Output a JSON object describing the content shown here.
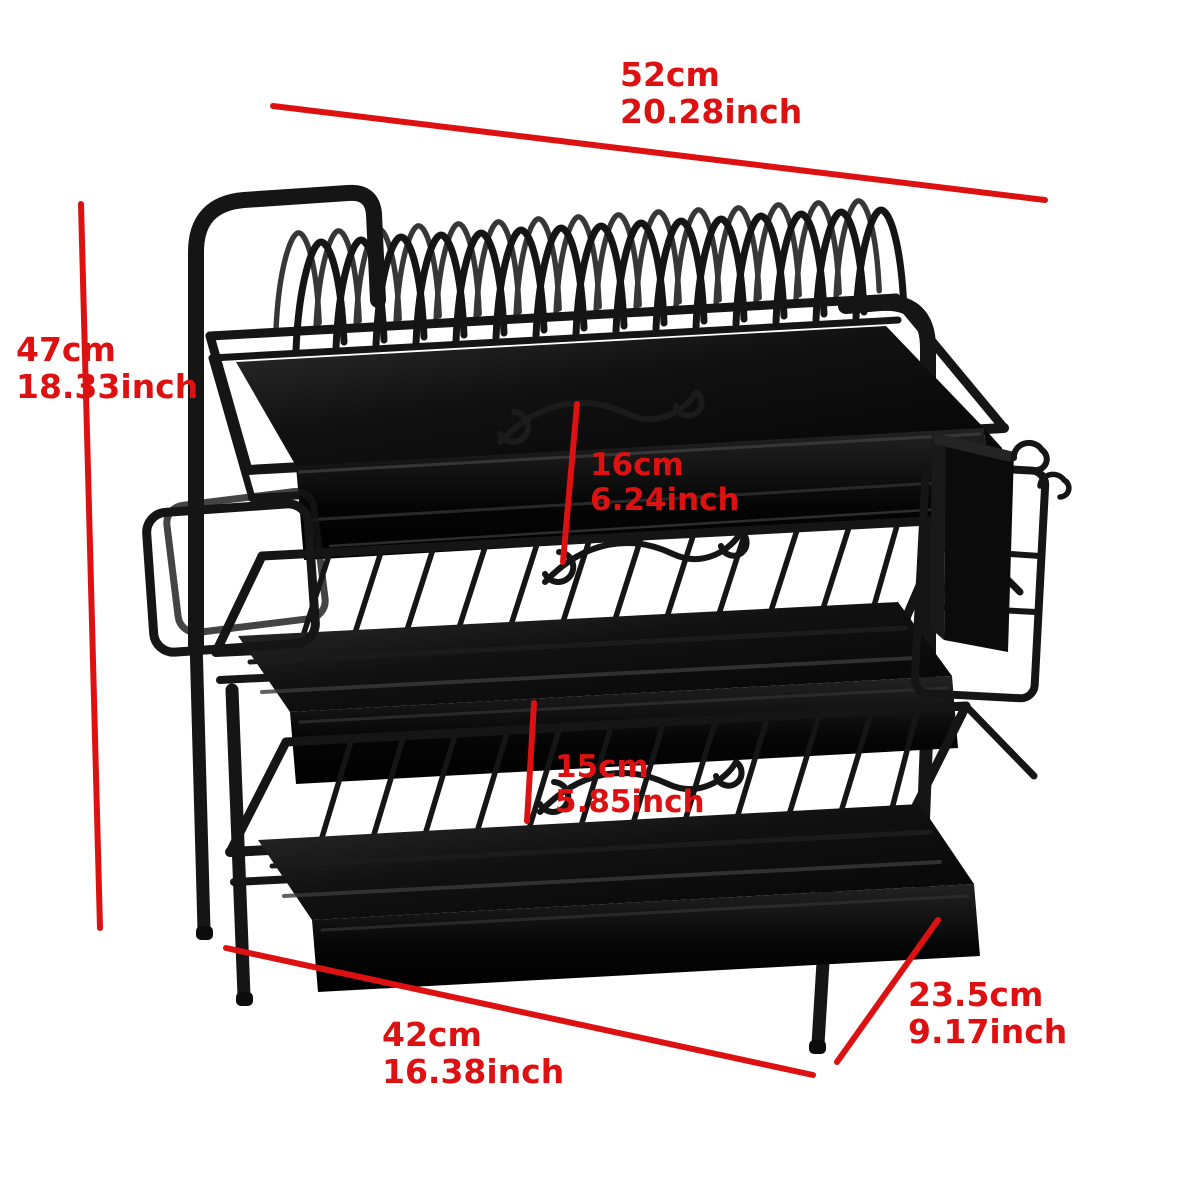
{
  "image": {
    "description": "Three-tier black metal kitchen dish drying rack with drip trays, plate arches, side board holder and hanging utensil cup",
    "background_color": "#ffffff"
  },
  "annotation": {
    "color": "#dd1111",
    "dimensions": {
      "top_width": {
        "cm": "52cm",
        "inch": "20.28inch"
      },
      "left_height": {
        "cm": "47cm",
        "inch": "18.33inch"
      },
      "middle_gap": {
        "cm": "16cm",
        "inch": "6.24inch"
      },
      "lower_gap": {
        "cm": "15cm",
        "inch": "5.85inch"
      },
      "bottom_width": {
        "cm": "42cm",
        "inch": "16.38inch"
      },
      "depth": {
        "cm": "23.5cm",
        "inch": "9.17inch"
      }
    }
  }
}
